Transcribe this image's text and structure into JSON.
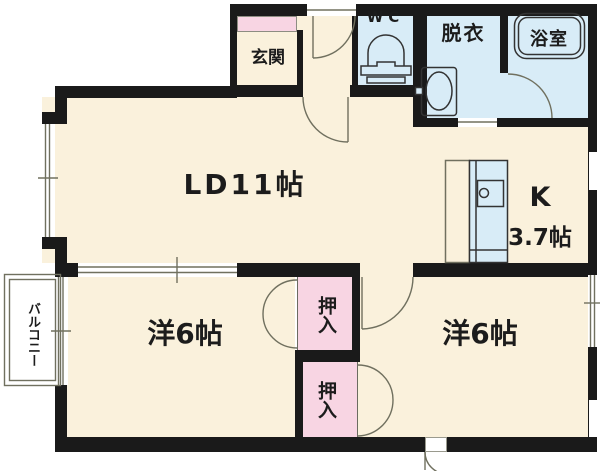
{
  "floorplan": {
    "kind": "apartment floor plan (2LDK)",
    "rooms": {
      "genkan": {
        "label": "玄関"
      },
      "wc": {
        "label": "WC"
      },
      "datsui": {
        "label": "脱衣"
      },
      "bathroom": {
        "label": "浴室"
      },
      "living_dining": {
        "label": "LD11帖"
      },
      "kitchen": {
        "label": "K",
        "size": "3.7帖"
      },
      "closet_top": {
        "label": "押入"
      },
      "closet_bottom": {
        "label": "押入"
      },
      "bedroom_left": {
        "label": "洋6帖"
      },
      "bedroom_right": {
        "label": "洋6帖"
      },
      "balcony": {
        "label": "バルコニー"
      }
    },
    "icons": {
      "toilet": "toilet-icon",
      "washbasin": "washbasin-icon",
      "bathtub": "bathtub-icon",
      "kitchen_counter": "kitchen-counter-icon"
    },
    "colors": {
      "wall": "#1a1a1a",
      "room_cream": "#faf1dc",
      "wet_area_blue": "#d8ecf7",
      "closet_pink": "#f8d5e3",
      "linework": "#70705f",
      "text": "#1c1c1c",
      "background": "#ffffff"
    }
  }
}
